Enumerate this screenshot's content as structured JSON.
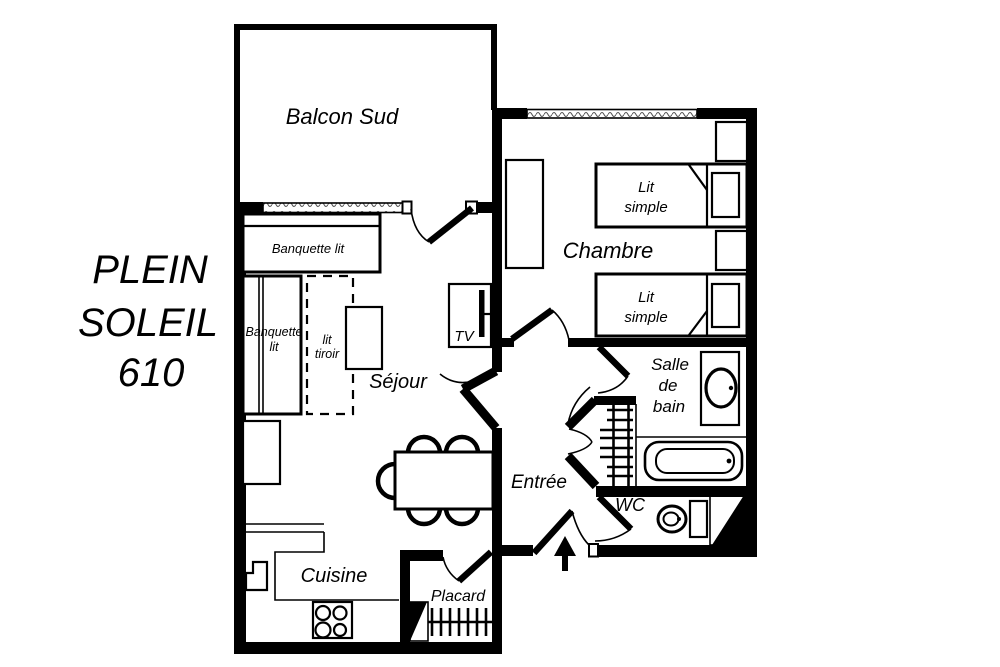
{
  "title": {
    "line1": "PLEIN",
    "line2": "SOLEIL",
    "line3": "610"
  },
  "rooms": {
    "balcony": "Balcon Sud",
    "bedroom": "Chambre",
    "living": "Séjour",
    "kitchen": "Cuisine",
    "entry": "Entrée",
    "bathroom": [
      "Salle",
      "de",
      "bain"
    ],
    "wc": "WC",
    "closet": "Placard"
  },
  "furniture": {
    "banquette_h": "Banquette lit",
    "banquette_v": [
      "Banquette",
      "lit"
    ],
    "drawer_bed": [
      "lit",
      "tiroir"
    ],
    "tv": "TV",
    "bed1": [
      "Lit",
      "simple"
    ],
    "bed2": [
      "Lit",
      "simple"
    ]
  },
  "colors": {
    "ink": "#000000",
    "paper": "#ffffff"
  }
}
